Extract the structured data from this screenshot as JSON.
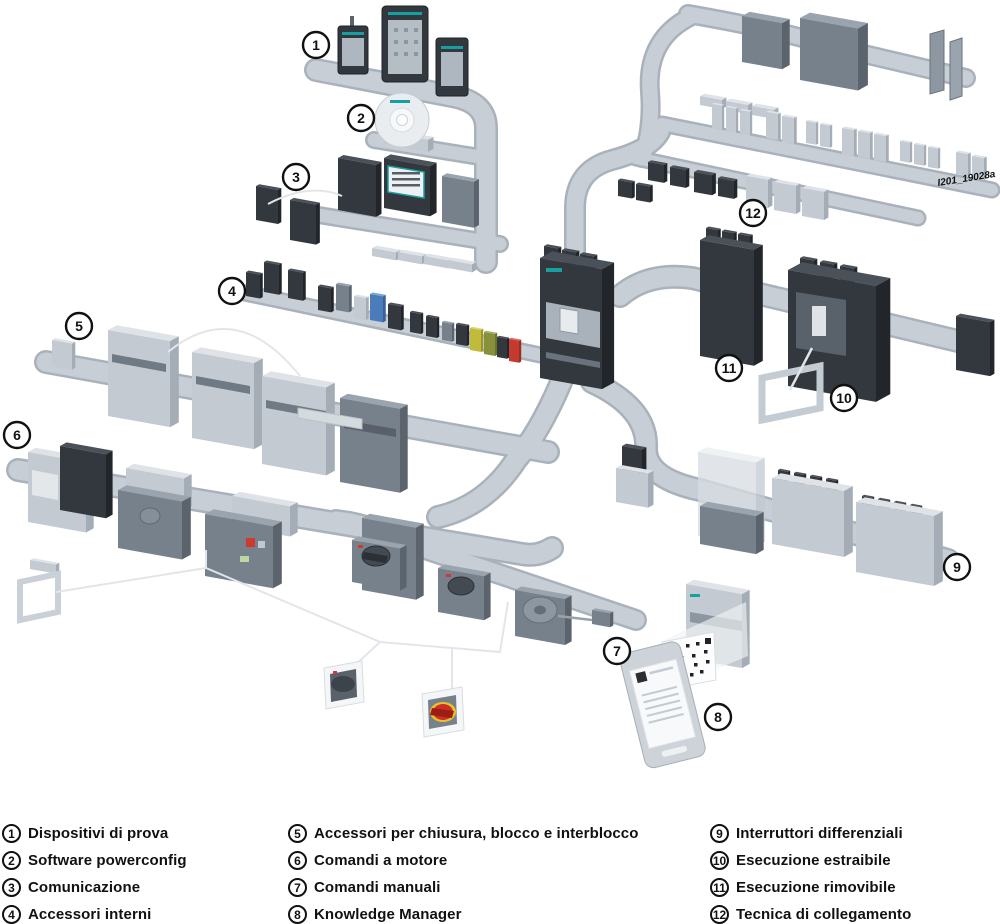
{
  "diagram": {
    "watermark": "I201_19028a",
    "callouts": [
      {
        "num": "1"
      },
      {
        "num": "2"
      },
      {
        "num": "3"
      },
      {
        "num": "4"
      },
      {
        "num": "5"
      },
      {
        "num": "6"
      },
      {
        "num": "7"
      },
      {
        "num": "8"
      },
      {
        "num": "9"
      },
      {
        "num": "10"
      },
      {
        "num": "11"
      },
      {
        "num": "12"
      }
    ]
  },
  "legend": {
    "columns": [
      {
        "items": [
          {
            "num": "1",
            "label": "Dispositivi di prova"
          },
          {
            "num": "2",
            "label": "Software powerconfig"
          },
          {
            "num": "3",
            "label": "Comunicazione"
          },
          {
            "num": "4",
            "label": "Accessori interni"
          }
        ]
      },
      {
        "items": [
          {
            "num": "5",
            "label": "Accessori per chiusura, blocco e interblocco"
          },
          {
            "num": "6",
            "label": "Comandi a motore"
          },
          {
            "num": "7",
            "label": "Comandi manuali"
          },
          {
            "num": "8",
            "label": "Knowledge Manager"
          }
        ]
      },
      {
        "items": [
          {
            "num": "9",
            "label": "Interruttori differenziali"
          },
          {
            "num": "10",
            "label": "Esecuzione estraibile"
          },
          {
            "num": "11",
            "label": "Esecuzione rimovibile"
          },
          {
            "num": "12",
            "label": "Tecnica di collegamento"
          }
        ]
      }
    ]
  },
  "colors": {
    "rail": "#c7ced6",
    "device_dark": "#33383f",
    "device_mid": "#77818c",
    "device_light": "#c3cad2",
    "accent_teal": "#18a0a0",
    "emergency_red": "#cf2e26",
    "emergency_yellow": "#e6c32b",
    "background": "#ffffff"
  }
}
